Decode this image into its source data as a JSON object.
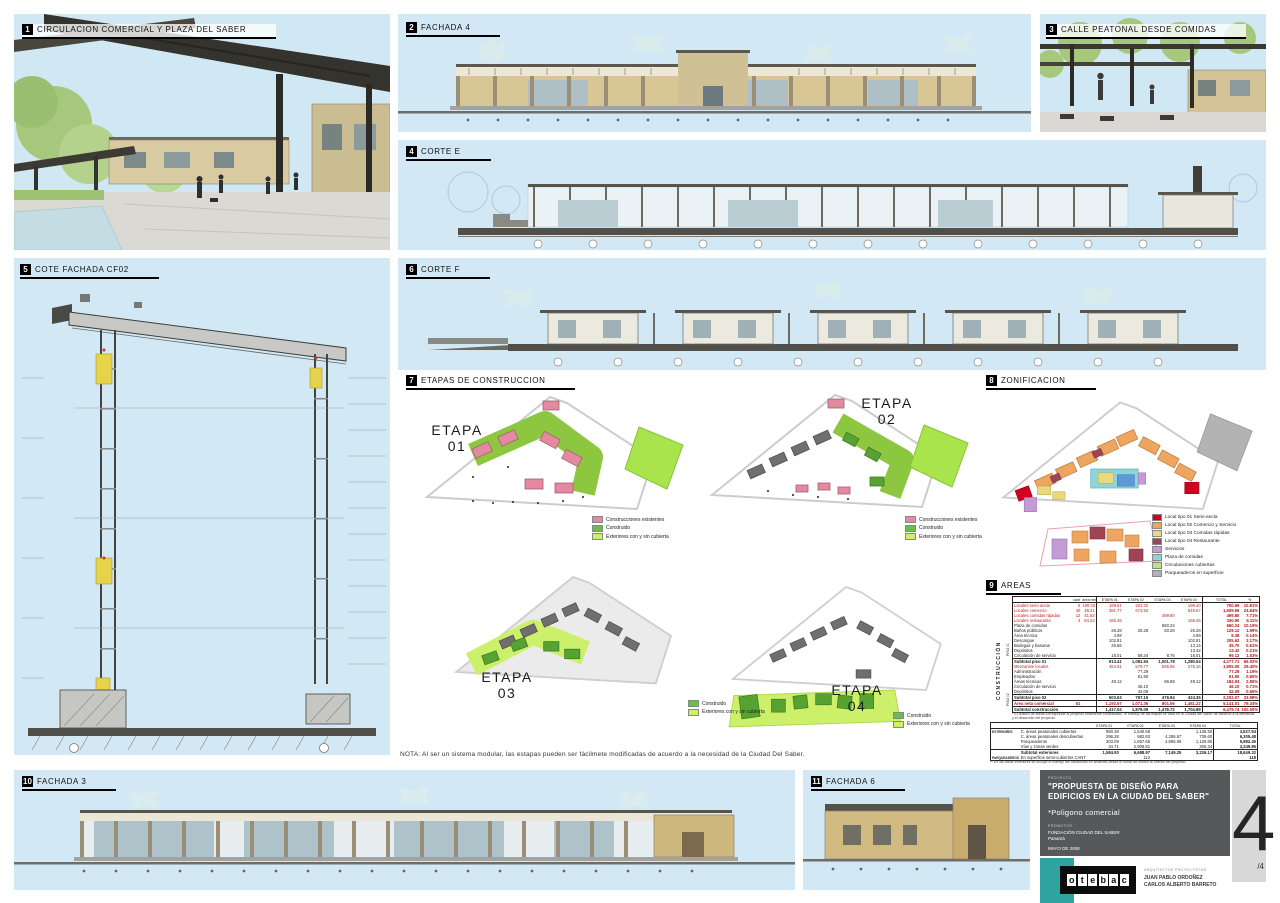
{
  "panels": {
    "p1": {
      "num": "1",
      "title": "CIRCULACION COMERCIAL Y PLAZA DEL SABER"
    },
    "p2": {
      "num": "2",
      "title": "FACHADA 4"
    },
    "p3": {
      "num": "3",
      "title": "CALLE PEATONAL DESDE COMIDAS"
    },
    "p4": {
      "num": "4",
      "title": "CORTE E"
    },
    "p5": {
      "num": "5",
      "title": "COTE FACHADA CF02"
    },
    "p6": {
      "num": "6",
      "title": "CORTE F"
    },
    "p7": {
      "num": "7",
      "title": "ETAPAS DE CONSTRUCCION"
    },
    "p8": {
      "num": "8",
      "title": "ZONIFICACION"
    },
    "p9": {
      "num": "9",
      "title": "AREAS"
    },
    "p10": {
      "num": "10",
      "title": "FACHADA 3"
    },
    "p11": {
      "num": "11",
      "title": "FACHADA 6"
    }
  },
  "etapas": {
    "e1": {
      "word": "ETAPA",
      "num": "01"
    },
    "e2": {
      "word": "ETAPA",
      "num": "02"
    },
    "e3": {
      "word": "ETAPA",
      "num": "03"
    },
    "e4": {
      "word": "ETAPA",
      "num": "04"
    },
    "legend_full": [
      {
        "color": "#e28ba0",
        "label": "Construcciones existentes"
      },
      {
        "color": "#6abf45",
        "label": "Construido"
      },
      {
        "color": "#cdf06b",
        "label": "Exteriores con y sin cubierta"
      }
    ],
    "legend_short": [
      {
        "color": "#6abf45",
        "label": "Construido"
      },
      {
        "color": "#cdf06b",
        "label": "Exteriores con y sin cubierta"
      }
    ],
    "nota": "NOTA: Al ser un sistema modular, las estapas pueden ser fácilmete modificadas de acuerdo a la necesidad de la Ciudad Del Saber."
  },
  "zonificacion": {
    "legend": [
      {
        "color": "#d1001f",
        "label": "Local tipo 01 Semi-ancla"
      },
      {
        "color": "#eda55f",
        "label": "Local tipo 02 Comercio y Servicio"
      },
      {
        "color": "#ead97c",
        "label": "Local tipo 03 Comidas rápidas"
      },
      {
        "color": "#a04454",
        "label": "Local tipo 04 Restaurante"
      },
      {
        "color": "#c49bd4",
        "label": "Servicios"
      },
      {
        "color": "#8fd4d9",
        "label": "Plaza de comidas"
      },
      {
        "color": "#b5e878",
        "label": "Circulaciones cubiertas"
      },
      {
        "color": "#b3b3b3",
        "label": "Parqueaderos en superficie"
      }
    ]
  },
  "areas": {
    "side_label": "CONSTRUCCIÓN",
    "group1": "PISO 01",
    "group2": "PISO 02",
    "table1": {
      "headers": [
        "",
        "cant",
        "área media",
        "ETAPA 01",
        "ETAPA 02",
        "ETAPA 03",
        "ETAPA 04",
        "TOTAL",
        "%"
      ],
      "rows": [
        {
          "s": "red",
          "c": [
            "Locales semi-ancla",
            "5",
            "100.03",
            "188.61",
            "203.32",
            "",
            "198.40",
            "700.69",
            "10.81%"
          ]
        },
        {
          "s": "red",
          "c": [
            "Locales comercio",
            "40",
            "38.21",
            "381.77",
            "673.92",
            "",
            "545.57",
            "1,609.66",
            "24.84%"
          ]
        },
        {
          "s": "red",
          "c": [
            "Locales comidas rápidas",
            "12",
            "41.63",
            "",
            "",
            "499.80",
            "",
            "499.80",
            "7.71%"
          ]
        },
        {
          "s": "red",
          "c": [
            "Locales restaurante",
            "4",
            "84.24",
            "165.45",
            "",
            "",
            "165.45",
            "330.90",
            "5.11%"
          ]
        },
        {
          "s": "",
          "c": [
            "Plaza de comidas",
            "",
            "",
            "",
            "",
            "660.24",
            "",
            "660.24",
            "10.19%"
          ]
        },
        {
          "s": "",
          "c": [
            "Baños públicos",
            "",
            "",
            "26.28",
            "26.28",
            "50.28",
            "26.28",
            "129.12",
            "1.99%"
          ]
        },
        {
          "s": "",
          "c": [
            "Área técnica",
            "",
            "",
            "4.69",
            "",
            "",
            "4.69",
            "9.38",
            "0.14%"
          ]
        },
        {
          "s": "",
          "c": [
            "Descargue",
            "",
            "",
            "102.81",
            "",
            "",
            "102.81",
            "205.62",
            "3.17%"
          ]
        },
        {
          "s": "",
          "c": [
            "Bodegas y basuras",
            "",
            "",
            "26.56",
            "",
            "",
            "13.14",
            "39.70",
            "0.61%"
          ]
        },
        {
          "s": "",
          "c": [
            "Depósitos",
            "",
            "",
            "",
            "",
            "",
            "13.42",
            "13.42",
            "0.21%"
          ]
        },
        {
          "s": "",
          "c": [
            "Circulación de servicio",
            "",
            "",
            "16.01",
            "58.34",
            "8.76",
            "16.01",
            "99.12",
            "1.53%"
          ]
        },
        {
          "s": "boldrow",
          "c": [
            "Subtotal piso 01",
            "",
            "",
            "913.41",
            "1,081.94",
            "1,001.78",
            "1,280.54",
            "4,277.71",
            "66.02%"
          ]
        },
        {
          "s": "red",
          "c": [
            "Mezzanine locales",
            "",
            "",
            "454.51",
            "579.77",
            "595.56",
            "275.16",
            "1,905.00",
            "29.40%"
          ]
        },
        {
          "s": "",
          "c": [
            "Administración",
            "",
            "",
            "",
            "77.29",
            "",
            "",
            "77.29",
            "1.19%"
          ]
        },
        {
          "s": "",
          "c": [
            "Empleados",
            "",
            "",
            "",
            "51.90",
            "",
            "",
            "51.90",
            "0.80%"
          ]
        },
        {
          "s": "",
          "c": [
            "Áreas técnicas",
            "",
            "",
            "49.12",
            "",
            "86.69",
            "49.12",
            "184.93",
            "2.85%"
          ]
        },
        {
          "s": "",
          "c": [
            "Circulación de servicio",
            "",
            "",
            "",
            "46.10",
            "",
            "",
            "46.10",
            "0.71%"
          ]
        },
        {
          "s": "",
          "c": [
            "Depósitos",
            "",
            "",
            "",
            "42.09",
            "",
            "",
            "42.09",
            "0.65%"
          ]
        },
        {
          "s": "boldrow",
          "c": [
            "Subtotal piso 02",
            "",
            "",
            "503.63",
            "797.15",
            "476.94",
            "424.35",
            "2,202.07",
            "33.98%"
          ]
        },
        {
          "s": "redbold",
          "c": [
            "Área neta comercial",
            "61",
            "",
            "1,193.57",
            "1,071.36",
            "801.56",
            "1,461.22",
            "5,141.01",
            "79.34%"
          ]
        },
        {
          "s": "boldrow",
          "c": [
            "Subtotal construcción",
            "",
            "",
            "1,417.04",
            "1,879.09",
            "1,478.72",
            "1,704.89",
            "6,479.74",
            "100.00%"
          ]
        }
      ]
    },
    "footnote1": "* El cuadro de áreas corresponde al proyecto totalmente consolidado, el manejo de las etapas se dará en la Ciudad del Saber de acuerdo a la demanda y el desarrollo del proyecto.",
    "table2": {
      "headers": [
        "",
        "",
        "ETAPA 01",
        "ETAPA 02",
        "ETAPA 03",
        "ETAPA 04",
        "TOTAL"
      ],
      "rows": [
        {
          "s": "",
          "c": [
            "EXTERIORES",
            "C. áreas peatonales cubiertas",
            "950.38",
            "1,540.66",
            "",
            "1,136.50",
            "3,627.54"
          ]
        },
        {
          "s": "",
          "c": [
            "",
            "C. áreas peatonales descubiertas",
            "296.28",
            "982.93",
            "4,286.67",
            "739.60",
            "6,305.48"
          ]
        },
        {
          "s": "",
          "c": [
            "",
            "Parqueaderos",
            "303.09",
            "1,657.65",
            "2,895.06",
            "1,126.65",
            "5,982.45"
          ]
        },
        {
          "s": "",
          "c": [
            "",
            "Vías y zonas verdes",
            "34.71",
            "2,908.81",
            "",
            "306.34",
            "3,249.86"
          ]
        },
        {
          "s": "boldrow",
          "c": [
            "",
            "Subtotal exteriores",
            "1,584.93",
            "6,688.97",
            "7,149.25",
            "3,226.17",
            "18,649.32"
          ]
        },
        {
          "s": "",
          "c": [
            "PARQUEADEROS",
            "En superficie semi-cubiertos   CANT",
            "",
            "112",
            "",
            "",
            "118"
          ]
        }
      ]
    },
    "footnote2": "** En las áreas exteriores se incluye el manejo del urbanismo en andenes desde el borde de control al interior del proyecto."
  },
  "titleblock": {
    "project_label": "PROYECTO",
    "title1": "\"PROPUESTA DE DISEÑO PARA",
    "title2": "EDIFICIOS EN LA CIUDAD DEL SABER\"",
    "subtitle": "*Poligono comercial",
    "client_label": "PROMOTOR",
    "client": "FUNDACIÓN CIUDAD DEL SABER",
    "client_location": "Panamá",
    "date": "MAYO DE 2008",
    "architects_label": "ARQUITECTOS PROYECTISTAS",
    "architect1": "JUAN PABLO ORDOÑEZ",
    "architect2": "CARLOS ALBERTO BARRETO",
    "logo_letters": [
      "o",
      "t",
      "e",
      "b",
      "a",
      "c"
    ],
    "sheet_number": "4",
    "sheet_total": "/4"
  }
}
